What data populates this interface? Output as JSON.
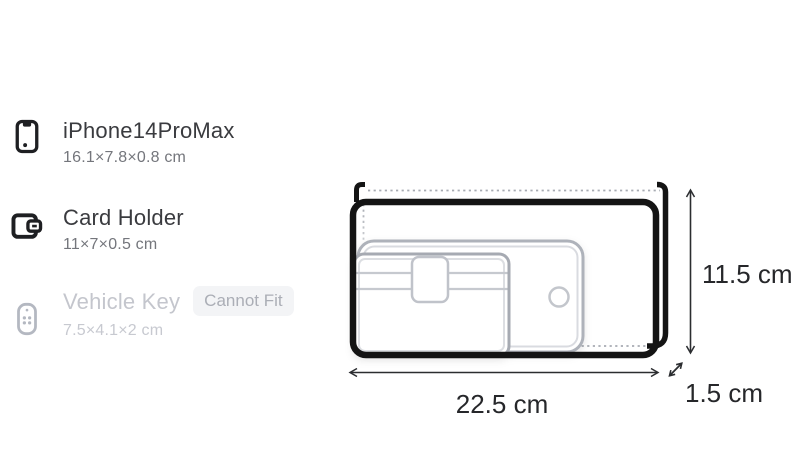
{
  "item_list": {
    "items": [
      {
        "name": "iPhone14ProMax",
        "dimensions": "16.1×7.8×0.8 cm",
        "icon": "smartphone-icon",
        "status": "fits"
      },
      {
        "name": "Card Holder",
        "dimensions": "11×7×0.5 cm",
        "icon": "wallet-icon",
        "status": "fits"
      },
      {
        "name": "Vehicle Key",
        "dimensions": "7.5×4.1×2 cm",
        "icon": "key-fob-icon",
        "status": "cannot-fit",
        "badge": "Cannot Fit"
      }
    ]
  },
  "bag_diagram": {
    "width_label": "22.5 cm",
    "height_label": "11.5 cm",
    "depth_label": "1.5 cm",
    "contents": [
      "smartphone-ghost",
      "card-holder-ghost"
    ]
  },
  "colors": {
    "bag_outline": "#141414",
    "ghost_stroke": "#aeb2ba",
    "dotted_line": "#a7abb2",
    "arrow": "#2b2d30",
    "title_text": "#3a3b3f",
    "subtitle_text": "#74767c",
    "disabled_text": "#c4c6cd",
    "badge_bg": "#f3f4f6",
    "badge_text": "#abaeb6",
    "background": "#ffffff"
  }
}
